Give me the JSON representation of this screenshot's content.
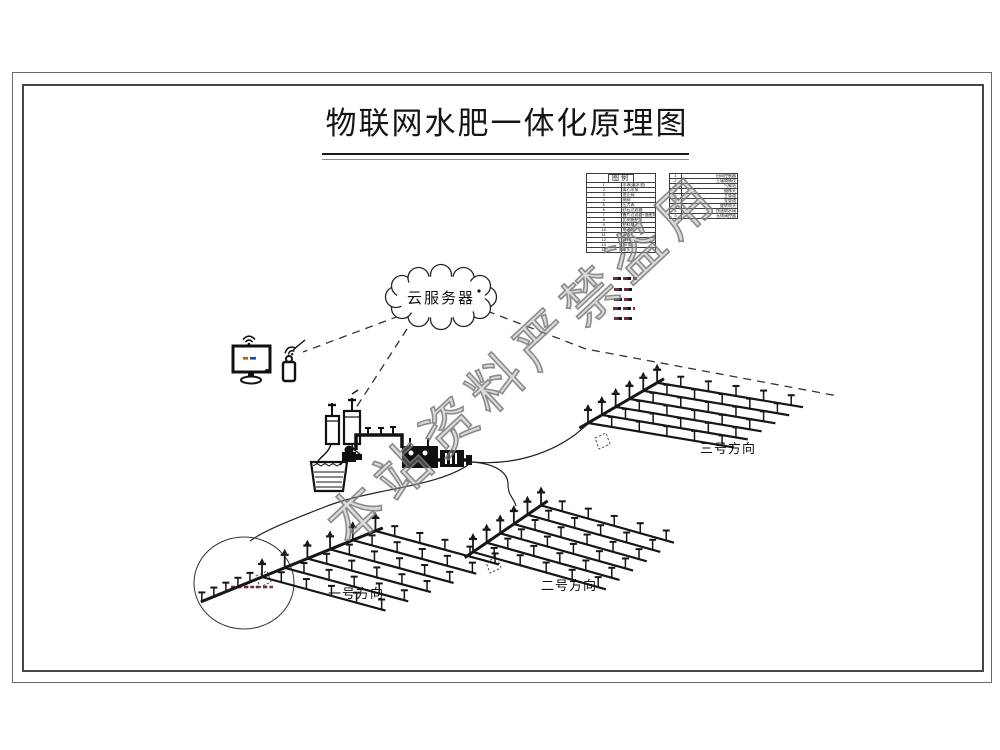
{
  "page": {
    "title": "物联网水肥一体化原理图"
  },
  "cloud": {
    "label": "云服务器"
  },
  "legend": {
    "title": "图例",
    "left_rows": [
      {
        "no": "1",
        "name": "水源(蓄水池)"
      },
      {
        "no": "2",
        "name": "离心水泵"
      },
      {
        "no": "3",
        "name": "逆止阀"
      },
      {
        "no": "4",
        "name": "闸阀"
      },
      {
        "no": "5",
        "name": "压力表"
      },
      {
        "no": "6",
        "name": "砂石过滤器"
      },
      {
        "no": "7",
        "name": "叠片过滤器+施肥机"
      },
      {
        "no": "8",
        "name": "比例施肥泵"
      },
      {
        "no": "9",
        "name": "肥料桶"
      },
      {
        "no": "10",
        "name": "电磁阀"
      },
      {
        "no": "11",
        "name": "水表"
      },
      {
        "no": "12",
        "name": "球阀"
      },
      {
        "no": "13",
        "name": "PE管"
      },
      {
        "no": "14",
        "name": "喷头"
      }
    ],
    "right_rows": [
      {
        "no": "1",
        "name": "田间控制器"
      },
      {
        "no": "2",
        "name": "土壤墒情仪"
      },
      {
        "no": "3",
        "name": "气象站"
      },
      {
        "no": "4",
        "name": "摄像头"
      },
      {
        "no": "5",
        "name": "主管道"
      },
      {
        "no": "6",
        "name": "支管道"
      },
      {
        "no": "7",
        "name": "旋转喷头"
      },
      {
        "no": "8",
        "name": "快速取水阀"
      },
      {
        "no": "9",
        "name": "无线阀控器"
      }
    ]
  },
  "fields": [
    {
      "label": "一号方向"
    },
    {
      "label": "二号方向"
    },
    {
      "label": "三号方向"
    }
  ],
  "watermark": {
    "text": "本站资料严禁盗用",
    "color": "#9e9e9e"
  },
  "colors": {
    "line": "#161616",
    "frame": "#474747",
    "watermark_grey": "#9e9e9e",
    "annotation_red": "#9a1f1f",
    "annotation_blue": "#20398c"
  }
}
